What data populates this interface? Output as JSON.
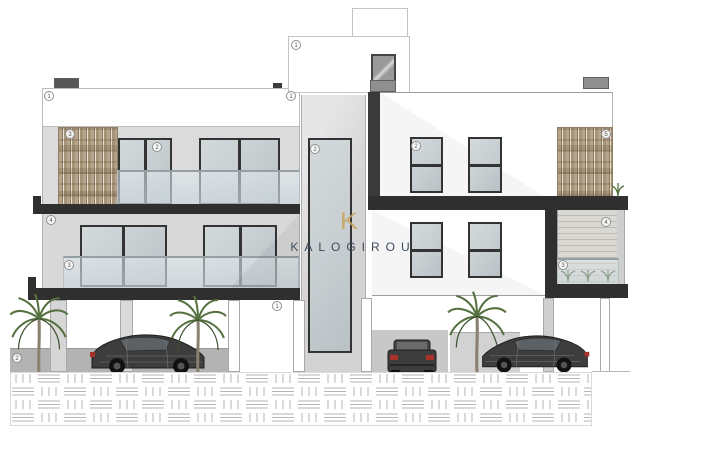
{
  "watermark": {
    "logo_letter": "K",
    "name": "KALOGIROU",
    "logo_color": "#c9a55e",
    "name_color": "#3e4c5e"
  },
  "callouts": {
    "c01": {
      "label": "1"
    },
    "c02": {
      "label": "1"
    },
    "c03": {
      "label": "1"
    },
    "c04": {
      "label": "3"
    },
    "c05": {
      "label": "2"
    },
    "c06": {
      "label": "2"
    },
    "c07": {
      "label": "4"
    },
    "c08": {
      "label": "3"
    },
    "c09": {
      "label": "1"
    },
    "c10": {
      "label": "2"
    },
    "c11": {
      "label": "2"
    },
    "c12": {
      "label": "4"
    },
    "c13": {
      "label": "3"
    },
    "c14": {
      "label": "5"
    }
  },
  "palette": {
    "slab_dark": "#2f2f2f",
    "wall_light_grey": "#dbdbdb",
    "wall_white": "#ffffff",
    "window_glass": "#c7ced1",
    "wood_slats": "#b1a088",
    "rail_glass": "rgba(214,226,232,0.6)",
    "car_body": "#3d3d3d",
    "taillight_red": "#a8322a",
    "palm_green": "#55713f",
    "hatch_line": "#b5b5b5"
  },
  "scene": {
    "drawing_kind": "front elevation",
    "blocks": [
      "left-two-storey-block",
      "central-stair-tower",
      "right-two-storey-block"
    ],
    "cars": [
      {
        "view": "side",
        "facing": "right"
      },
      {
        "view": "rear",
        "facing": "away"
      },
      {
        "view": "side",
        "facing": "left"
      }
    ],
    "palm_count": 3
  }
}
